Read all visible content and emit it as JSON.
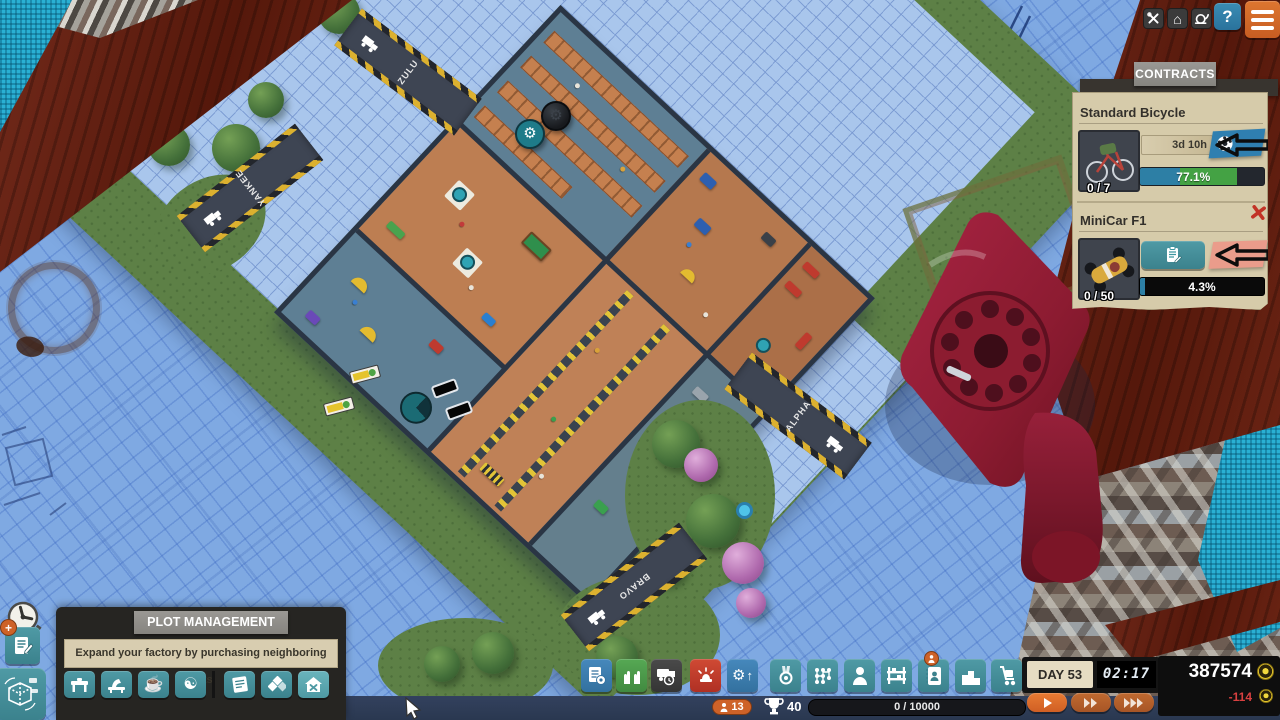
{
  "topbar": {
    "help_label": "?"
  },
  "icons": {
    "gear": "⚙",
    "home": "⌂",
    "yin_yang": "☯",
    "coffee": "☕",
    "pencil": "✎",
    "arrow_up": "↑",
    "plus": "+"
  },
  "contracts": {
    "title": "CONTRACTS",
    "cards": [
      {
        "title": "Standard Bicycle",
        "count": "0 / 7",
        "time_left": "3d 10h",
        "progress_label": "77.1%",
        "progress_value": 77.1,
        "seg_blue": 32,
        "seg_green": 46
      },
      {
        "title": "MiniCar F1",
        "count": "0 / 50",
        "progress_label": "4.3%",
        "progress_value": 4.3,
        "seg_blue": 4.3
      }
    ]
  },
  "plot_tooltip": {
    "title": "PLOT MANAGEMENT",
    "body": "Expand your factory by purchasing neighboring plots."
  },
  "scene": {
    "docks": [
      {
        "label": "ZULU"
      },
      {
        "label": "YANKEE"
      },
      {
        "label": "ALPHA"
      },
      {
        "label": "BRAVO"
      }
    ],
    "sketch_note": "3,5x1"
  },
  "statusbar": {
    "workers_count": "13",
    "trophy_count": "40",
    "research_progress": "0 / 10000"
  },
  "clock": {
    "day_label": "DAY 53",
    "time": "02:17"
  },
  "money": {
    "balance": "387574",
    "delta": "-114"
  },
  "colors": {
    "accent_orange": "#ce6228",
    "teal_button": "#47929e",
    "alert_red": "#c03a2c",
    "progress_green": "#44a244",
    "progress_blue": "#2d7fa5",
    "money_negative": "#d84040",
    "blueprint": "#7fa9e2"
  }
}
